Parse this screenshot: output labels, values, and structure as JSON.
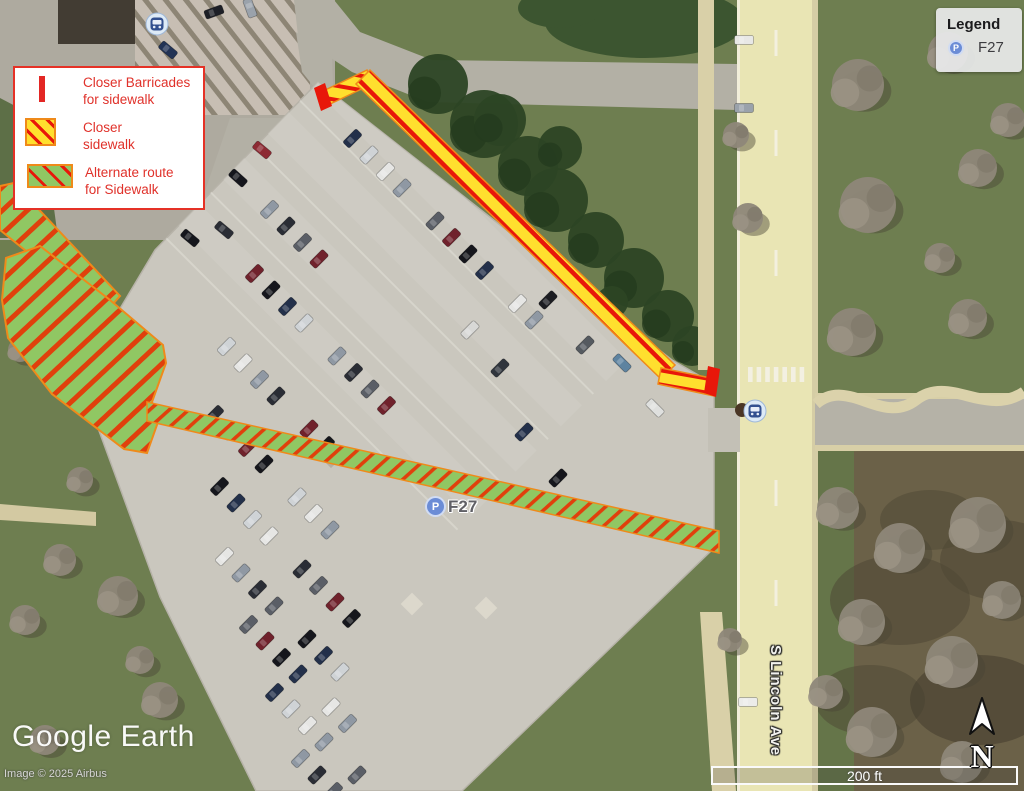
{
  "map": {
    "street_label": "S Lincoln Ave",
    "parking_marker": {
      "icon": "P",
      "label": "F27"
    }
  },
  "legend_key": {
    "items": [
      {
        "icon": "barricade-swatch",
        "line1": "Closer Barricades",
        "line2": "for sidewalk"
      },
      {
        "icon": "closed-sidewalk-swatch",
        "line1": "Closer",
        "line2": "sidewalk"
      },
      {
        "icon": "alternate-route-swatch",
        "line1": "Alternate route",
        "line2": "for Sidewalk"
      }
    ]
  },
  "legend_box": {
    "title": "Legend",
    "entry": {
      "icon": "P",
      "label": "F27"
    }
  },
  "watermark": {
    "brand": "Google Earth",
    "attribution": "Image © 2025 Airbus"
  },
  "scale_bar": {
    "label": "200 ft"
  },
  "compass": {
    "label": "N"
  },
  "colors": {
    "legend_red": "#e23127",
    "closed_sidewalk_yellow": "#ffdf2e",
    "alternate_route_green": "#90c763",
    "hatch_red": "#e8170a",
    "hatch_border_orange": "#ef8a1a",
    "marker_blue": "#6b8cd6"
  }
}
